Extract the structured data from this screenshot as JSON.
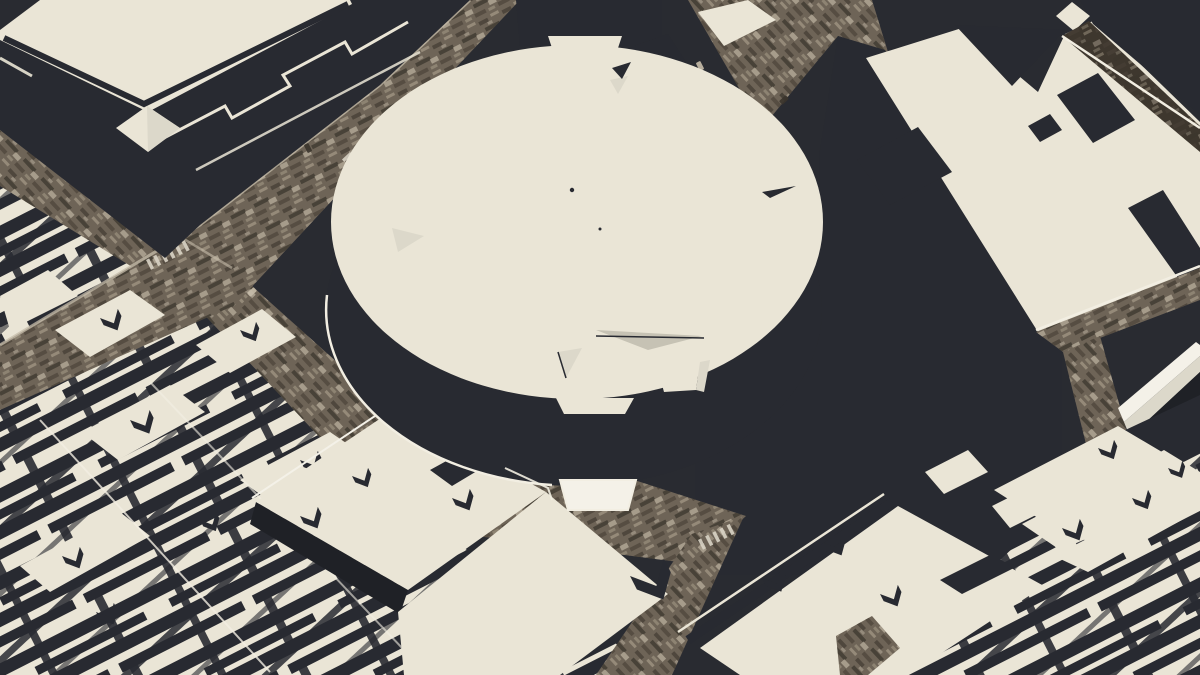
{
  "scene": {
    "canvas": {
      "width": 1200,
      "height": 675
    },
    "palette": {
      "ground": "#292b31",
      "side": "#282a31",
      "side_deep": "#1f2126",
      "roof": "#eae5d6",
      "roof_bright": "#f4f1e8",
      "roof_dim": "#dcd8ca",
      "roof_gray": "#c6c2b4",
      "white_line": "#f2eee2",
      "street_base": "#6e6457",
      "street_dark": "#4c443a",
      "street_darker": "#3a342c",
      "street_light": "#998e7d",
      "street_pale": "#c6bcaa",
      "street7": "#3e372e",
      "dash": "#d9d3c5"
    },
    "layers": [
      {
        "name": "ground",
        "kind": "poly",
        "pts": "0,0 1200,0 1200,675 0,675",
        "fill": "ground"
      },
      {
        "name": "district-blocks-southwest",
        "kind": "poly",
        "pts": "0,180 120,248 236,306 356,476 482,560 642,660 642,675 0,675",
        "fill": "pat:blocks"
      },
      {
        "name": "district-blocks-southwest-cross",
        "kind": "poly",
        "pts": "0,180 120,248 236,306 356,476 482,560 642,660 642,675 0,675",
        "fill": "pat:blocks2"
      },
      {
        "name": "street-eighth-avenue-upper",
        "kind": "street",
        "pts": "0,128 232,268 196,306 0,186",
        "pat": "spkB"
      },
      {
        "name": "street-eighth-avenue-lower",
        "kind": "street",
        "pts": "232,268 196,306 360,480 426,442",
        "pat": "spkB"
      },
      {
        "name": "street-33rd",
        "kind": "street",
        "pts": "0,345 200,225 380,85 470,0 520,0 430,95 235,305 0,410",
        "pat": "spkA"
      },
      {
        "name": "street-seventh-avenue-top",
        "kind": "street",
        "pts": "688,0 872,0 888,52 838,36 762,128",
        "pat": "spkB"
      },
      {
        "name": "sidewalk-line-33rd",
        "kind": "path",
        "d": "M0,345 L200,225 L380,85 L470,0",
        "stroke": "street_pale",
        "w": 3,
        "op": 0.75
      },
      {
        "name": "sidewalk-line-8av",
        "kind": "path",
        "d": "M0,128 L232,268",
        "stroke": "street_pale",
        "w": 2.5,
        "op": 0.6
      },
      {
        "name": "crosswalk-8av",
        "kind": "dashes",
        "x": 146,
        "y": 260,
        "rot": -27,
        "n": 6,
        "fill": "dash"
      },
      {
        "name": "crosswalk-33rd",
        "kind": "dashes",
        "x": 350,
        "y": 152,
        "rot": 47,
        "n": 5,
        "fill": "dash"
      },
      {
        "name": "vehicles",
        "kind": "cars",
        "items": [
          [
            252,
            292,
            47,
            "street_pale"
          ],
          [
            118,
            212,
            47,
            "#d8d2c4"
          ],
          [
            308,
            148,
            -27,
            "street_darker"
          ],
          [
            84,
            178,
            47,
            "street_light"
          ],
          [
            700,
            66,
            -27,
            "street_pale"
          ],
          [
            784,
            100,
            47,
            "street_darker"
          ]
        ]
      },
      {
        "name": "block-roof-sw-1",
        "kind": "poly",
        "pts": "55,330 130,290 165,315 90,357",
        "fill": "roof"
      },
      {
        "name": "block-roof-sw-2",
        "kind": "poly",
        "pts": "0,296 48,270 78,296 10,330",
        "fill": "roof"
      },
      {
        "name": "block-roof-sw-3",
        "kind": "poly",
        "pts": "196,345 262,309 296,337 230,373",
        "fill": "roof"
      },
      {
        "name": "block-roof-sw-4",
        "kind": "poly",
        "pts": "82,432 170,385 205,412 118,460",
        "fill": "roof"
      },
      {
        "name": "block-roof-sw-5",
        "kind": "poly",
        "pts": "240,480 330,432 368,458 278,507",
        "fill": "roof"
      },
      {
        "name": "block-roof-sw-6",
        "kind": "poly",
        "pts": "20,566 120,512 150,536 50,592",
        "fill": "roof"
      },
      {
        "name": "roof-vents-southwest",
        "kind": "vgroup",
        "fill": "side",
        "items": [
          [
            100,
            318,
            1,
            -27
          ],
          [
            240,
            330,
            0.9,
            -27
          ],
          [
            130,
            420,
            1.1,
            -27
          ],
          [
            300,
            460,
            1,
            -27
          ],
          [
            62,
            556,
            1,
            -27
          ],
          [
            200,
            520,
            0.9,
            -27
          ],
          [
            336,
            556,
            0.8,
            -27
          ],
          [
            96,
            612,
            1,
            -27
          ]
        ]
      },
      {
        "name": "alley-line-southwest-1",
        "kind": "path",
        "d": "M40,420 L270,672",
        "stroke": "white_line",
        "w": 2,
        "op": 0.8
      },
      {
        "name": "alley-line-southwest-2",
        "kind": "path",
        "d": "M150,382 L404,650",
        "stroke": "white_line",
        "w": 2,
        "op": 0.6
      },
      {
        "name": "post-office-mass",
        "kind": "poly",
        "pts": "0,34 143,107 345,0 470,0 380,85 200,225 165,258 0,130",
        "fill": "side"
      },
      {
        "name": "post-office-roof",
        "kind": "poly",
        "pts": "0,30 40,0 350,0 352,4 148,112 0,40",
        "fill": "roof"
      },
      {
        "name": "post-office-roof-inset",
        "kind": "path",
        "d": "M4,38 L144,104 L348,4",
        "stroke": "side",
        "w": 6,
        "op": 1
      },
      {
        "name": "post-office-parapet-zig1",
        "kind": "path",
        "d": "M160,140 L225,106 L232,118 L290,86 L283,75 L345,42 L352,54 L408,22",
        "stroke": "roof",
        "w": 3,
        "op": 1
      },
      {
        "name": "post-office-parapet-zig2",
        "kind": "path",
        "d": "M196,170 L420,52",
        "stroke": "roof",
        "w": 2.5,
        "op": 0.85
      },
      {
        "name": "post-office-parapet-left",
        "kind": "path",
        "d": "M0,58 L32,76",
        "stroke": "roof",
        "w": 3,
        "op": 0.9
      },
      {
        "name": "post-office-pavilion",
        "kind": "poly",
        "pts": "116,128 147,106 180,128 148,152",
        "fill": "roof"
      },
      {
        "name": "post-office-pavilion-shade",
        "kind": "poly",
        "pts": "147,106 180,128 148,152",
        "fill": "roof_dim"
      },
      {
        "name": "midtown-slab",
        "kind": "poly",
        "pts": "516,0 662,0 662,46 520,46",
        "fill": "side"
      },
      {
        "name": "midtown-slab-2",
        "kind": "poly",
        "pts": "628,48 668,34 686,62 646,78",
        "fill": "side"
      },
      {
        "name": "midtown-sliver-roof",
        "kind": "poly",
        "pts": "698,12 748,0 776,20 724,46",
        "fill": "roof"
      },
      {
        "name": "penn-tower-wall",
        "kind": "poly",
        "pts": "838,36 885,50 1062,335 1062,575 695,575 695,425 760,360 818,260 820,150",
        "fill": "side"
      },
      {
        "name": "penn-plaza-roof",
        "kind": "poly",
        "pts": "866,58 962,28 1038,92 1065,34 1095,20 1200,122 1200,270 1062,340 1038,332",
        "fill": "roof"
      },
      {
        "name": "penn-plaza-cleft",
        "kind": "poly",
        "pts": "955,25 1065,30 1012,86",
        "fill": "side"
      },
      {
        "name": "penn-plaza-recess-1",
        "kind": "poly",
        "pts": "857,160 918,127 952,172 890,205",
        "fill": "side"
      },
      {
        "name": "penn-plaza-recess-2",
        "kind": "poly",
        "pts": "1057,95 1098,73 1135,120 1093,143",
        "fill": "side"
      },
      {
        "name": "penn-plaza-recess-3",
        "kind": "poly",
        "pts": "1128,208 1163,190 1200,248 1200,288 1178,278",
        "fill": "side"
      },
      {
        "name": "penn-plaza-recess-4",
        "kind": "poly",
        "pts": "1028,126 1050,114 1062,130 1040,142",
        "fill": "side"
      },
      {
        "name": "corner-tower-wall",
        "kind": "poly",
        "pts": "1080,0 1200,0 1200,115 1093,24",
        "fill": "side"
      },
      {
        "name": "corner-tower-steps",
        "kind": "poly",
        "pts": "1056,16 1072,2 1090,16 1074,31",
        "fill": "roof"
      },
      {
        "name": "street-northeast",
        "kind": "street",
        "pts": "1062,36 1089,21 1200,126 1200,152",
        "base": "street7",
        "pat": "spkA",
        "op": 0.55
      },
      {
        "name": "street-northeast-curb",
        "kind": "path",
        "d": "M1062,36 L1200,128",
        "stroke": "white_line",
        "w": 2.5,
        "op": 1
      },
      {
        "name": "street-east",
        "kind": "street",
        "pts": "1036,332 1200,268 1200,300 1063,352",
        "pat": "spkA"
      },
      {
        "name": "street-east-curb",
        "kind": "path",
        "d": "M1036,330 L1200,266",
        "stroke": "white_line",
        "w": 2.5,
        "op": 1
      },
      {
        "name": "street-east-branch",
        "kind": "street",
        "pts": "1063,352 1100,336 1140,478 1098,492",
        "pat": "spkB"
      },
      {
        "name": "slab-building-top",
        "kind": "poly",
        "pts": "1118,408 1196,342 1200,345 1200,356 1124,422",
        "fill": "roof_bright"
      },
      {
        "name": "slab-building-side",
        "kind": "poly",
        "pts": "1124,422 1200,356 1200,372 1130,437",
        "fill": "roof_dim"
      },
      {
        "name": "slab-building-shadow",
        "kind": "poly",
        "pts": "1130,437 1200,372 1200,395 1136,460",
        "fill": "side_deep"
      },
      {
        "name": "district-blocks-southeast",
        "kind": "poly",
        "pts": "898,675 1000,560 1062,502 1200,440 1200,675",
        "fill": "pat:blocks"
      },
      {
        "name": "district-blocks-southeast-cross",
        "kind": "poly",
        "pts": "898,675 1000,560 1062,502 1200,440 1200,675",
        "fill": "pat:blocks2"
      },
      {
        "name": "terrace-gap",
        "kind": "poly",
        "pts": "1040,470 1200,395 1200,445 1080,505",
        "fill": "side"
      },
      {
        "name": "terrace-1",
        "kind": "poly",
        "pts": "994,490 1118,426 1162,452 1038,518",
        "fill": "roof"
      },
      {
        "name": "terrace-2",
        "kind": "poly",
        "pts": "1022,524 1164,450 1200,472 1200,490 1060,550",
        "fill": "roof"
      },
      {
        "name": "terrace-3",
        "kind": "poly",
        "pts": "1054,556 1200,480 1200,510 1088,572",
        "fill": "roof"
      },
      {
        "name": "roof-vents-southeast",
        "kind": "vgroup",
        "fill": "side",
        "items": [
          [
            1098,
            448,
            0.9,
            -27
          ],
          [
            1062,
            528,
            1,
            -27
          ],
          [
            1132,
            498,
            0.9,
            -27
          ],
          [
            1168,
            468,
            0.8,
            -27
          ]
        ]
      },
      {
        "name": "street-31st",
        "kind": "street",
        "pts": "402,458 448,420 746,516 694,564 430,530",
        "pat": "spkA"
      },
      {
        "name": "street-cross-south",
        "kind": "street",
        "pts": "692,534 744,516 672,675 596,675",
        "pat": "spkB"
      },
      {
        "name": "crosswalk-south",
        "kind": "dashes",
        "x": 698,
        "y": 540,
        "rot": -27,
        "n": 5,
        "fill": "dash"
      },
      {
        "name": "block-a-side",
        "kind": "poly",
        "pts": "256,502 408,590 400,614 250,524",
        "fill": "side_deep"
      },
      {
        "name": "block-a-roof",
        "kind": "poly",
        "pts": "256,502 396,408 546,492 408,590",
        "fill": "roof"
      },
      {
        "name": "block-a-roof-south",
        "kind": "poly",
        "pts": "398,612 546,492 668,594 560,675 404,675",
        "fill": "roof"
      },
      {
        "name": "block-a-recess",
        "kind": "poly",
        "pts": "430,470 470,448 492,462 452,486",
        "fill": "side"
      },
      {
        "name": "block-a-parapet-line",
        "kind": "path",
        "d": "M252,498 L393,404",
        "stroke": "roof_bright",
        "w": 2,
        "op": 1
      },
      {
        "name": "roof-vents-block-a",
        "kind": "vgroup",
        "fill": "side",
        "items": [
          [
            300,
            516,
            1,
            -27
          ],
          [
            352,
            476,
            0.9,
            -27
          ],
          [
            452,
            498,
            1,
            -27
          ],
          [
            630,
            576,
            1.9,
            -27
          ]
        ]
      },
      {
        "name": "small-roof-east-1",
        "kind": "poly",
        "pts": "925,472 968,450 988,472 944,494",
        "fill": "roof"
      },
      {
        "name": "small-roof-east-2",
        "kind": "poly",
        "pts": "992,506 1036,484 1054,506 1010,528",
        "fill": "roof"
      },
      {
        "name": "block-b-roof",
        "kind": "poly",
        "pts": "700,648 898,506 1044,586 908,675 740,675",
        "fill": "roof"
      },
      {
        "name": "block-b-edge-band",
        "kind": "path",
        "d": "M688,640 L892,502",
        "stroke": "side",
        "w": 9,
        "op": 1
      },
      {
        "name": "block-b-parapet-line",
        "kind": "path",
        "d": "M678,632 L884,494",
        "stroke": "roof",
        "w": 2.5,
        "op": 1
      },
      {
        "name": "block-b-recess",
        "kind": "poly",
        "pts": "940,580 992,554 1014,568 962,594",
        "fill": "side"
      },
      {
        "name": "roof-vents-block-b",
        "kind": "vgroup",
        "fill": "side",
        "items": [
          [
            762,
            578,
            1.1,
            -27
          ],
          [
            824,
            543,
            1,
            -27
          ],
          [
            880,
            594,
            1,
            -27
          ]
        ]
      },
      {
        "name": "street-patch-south",
        "kind": "street",
        "pts": "836,636 872,616 900,648 868,675 840,675",
        "pat": "spkB"
      },
      {
        "name": "arena-cylinder-side",
        "kind": "ellipse",
        "cx": 574,
        "cy": 310,
        "rx": 248,
        "ry": 176,
        "fill": "side"
      },
      {
        "name": "arena-base-outline",
        "kind": "path",
        "d": "M552,485 A248,176 0 0 1 327,295",
        "stroke": "white_line",
        "w": 2.5,
        "op": 1
      },
      {
        "name": "arena-roof",
        "kind": "ellipse",
        "cx": 577,
        "cy": 222,
        "rx": 246,
        "ry": 177,
        "fill": "roof"
      },
      {
        "name": "arena-roof-tab",
        "kind": "poly",
        "pts": "548,36 622,36 616,54 554,54",
        "fill": "roof"
      },
      {
        "name": "arena-entry-upper",
        "kind": "poly",
        "pts": "556,398 634,398 625,414 564,414",
        "fill": "roof"
      },
      {
        "name": "arena-entry-lower",
        "kind": "poly",
        "pts": "560,480 636,480 628,510 568,510",
        "fill": "roof_bright",
        "stroke": "white_line",
        "sw": 2
      },
      {
        "name": "arena-base-zig",
        "kind": "path",
        "d": "M505,468 L548,488 L552,500",
        "stroke": "white_line",
        "w": 2,
        "op": 0.9
      },
      {
        "name": "arena-ledge-right-1",
        "kind": "poly",
        "pts": "658,370 700,362 696,390 664,392",
        "fill": "roof"
      },
      {
        "name": "arena-ledge-right-2",
        "kind": "poly",
        "pts": "700,362 710,360 704,392 696,390",
        "fill": "roof_dim"
      },
      {
        "name": "arena-facet-1",
        "kind": "poly",
        "pts": "392,228 424,236 398,252",
        "fill": "roof_dim"
      },
      {
        "name": "arena-facet-2",
        "kind": "poly",
        "pts": "596,330 702,336 648,350",
        "fill": "roof_gray"
      },
      {
        "name": "arena-facet-2-line",
        "kind": "path",
        "d": "M596,336 L704,338",
        "stroke": "side",
        "w": 1.5,
        "op": 1
      },
      {
        "name": "arena-facet-3",
        "kind": "poly",
        "pts": "558,352 582,348 566,378",
        "fill": "roof_dim"
      },
      {
        "name": "arena-facet-3-line",
        "kind": "path",
        "d": "M558,352 L566,378",
        "stroke": "side",
        "w": 1.5,
        "op": 1
      },
      {
        "name": "arena-facet-4",
        "kind": "poly",
        "pts": "610,80 628,76 618,94",
        "fill": "roof_dim"
      },
      {
        "name": "arena-facet-4-dark",
        "kind": "poly",
        "pts": "612,68 631,62 622,79",
        "fill": "side"
      },
      {
        "name": "arena-facet-5",
        "kind": "poly",
        "pts": "762,192 796,186 770,198",
        "fill": "side"
      },
      {
        "name": "arena-roof-speck-1",
        "kind": "circle",
        "cx": 572,
        "cy": 190,
        "r": 2.2,
        "fill": "side"
      },
      {
        "name": "arena-roof-speck-2",
        "kind": "circle",
        "cx": 600,
        "cy": 229,
        "r": 1.5,
        "fill": "side"
      }
    ]
  }
}
